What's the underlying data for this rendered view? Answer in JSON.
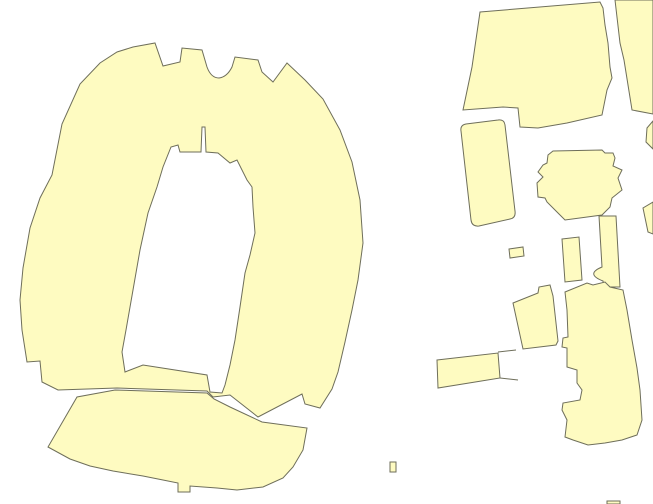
{
  "map": {
    "width": 653,
    "height": 504,
    "background_color": "#ffffff",
    "fill_color": "#FEFBC1",
    "outline_color": "#6E6E5A",
    "layer": "building-footprints",
    "shapes": [
      {
        "name": "feature-stadium-horseshoe",
        "kind": "polygon-with-hole",
        "d": "M27,362 L22,330 L20,300 L23,268 L30,228 L40,198 L52,175 L62,124 L80,84 L100,63 L117,52 L133,47 L155,43 L163,66 L180,62 L182,48 L202,50 L207,67 Q211,78 219,78 Q227,77 232,67 L235,57 L258,60 L262,72 L273,82 L287,63 L305,80 L323,99 L340,130 L352,162 L360,200 L363,243 L358,280 L352,310 L345,342 L338,372 L332,389 L320,408 L305,404 L302,394 L258,417 L230,395 L213,397 L207,391 L117,388 L58,390 L42,382 L40,361 Z M125,372 L122,352 L126,330 L133,290 L140,250 L148,213 L157,187 L163,167 L171,147 L178,145 L180,152 L192,152 L201,152 L202,127 L205,127 L206,152 L218,153 L230,163 L237,160 L247,180 L252,187 L253,207 L255,233 L250,255 L245,273 L240,307 L235,340 L230,365 L225,385 L222,393 L210,392 L207,375 L143,365 Z"
      },
      {
        "name": "feature-south-stands-fan",
        "kind": "polygon",
        "d": "M115,390 L207,393 L214,399 L230,407 L262,422 L307,428 L303,450 L293,467 L283,478 L263,487 L237,490 L217,488 L190,486 L190,492 L178,492 L178,483 L163,480 L143,476 L113,471 L90,466 L70,459 L48,447 L77,397 Z"
      },
      {
        "name": "feature-building-north-trapezoid",
        "kind": "polygon",
        "d": "M480,12 L600,2 L603,8 L605,25 L608,43 L610,67 L612,78 L607,90 L602,115 L567,123 L538,128 L520,127 L518,108 L503,107 L463,110 L472,67 Z"
      },
      {
        "name": "feature-building-top-right-edge",
        "kind": "polygon",
        "d": "M615,0 L620,43 L624,60 L632,110 L653,114 L653,0 Z"
      },
      {
        "name": "feature-building-right-edge-sliver-upper",
        "kind": "polygon",
        "d": "M653,121 L647,128 L646,142 L653,149 Z"
      },
      {
        "name": "feature-building-rounded-rect",
        "kind": "polygon",
        "d": "M466,124 L498,120 Q504,119 505,125 L515,211 Q516,218 510,219 L479,226 Q472,227 471,220 L461,131 Q460,125 466,124 Z"
      },
      {
        "name": "feature-building-cross",
        "kind": "polygon",
        "d": "M548,155 L553,151 L602,150 L605,153 L613,153 L615,158 L613,166 L622,170 L618,178 L622,190 L612,198 L610,207 L602,215 L565,220 L558,213 L547,202 L545,198 L538,197 L537,183 L543,177 L538,172 L543,165 L547,163 Z"
      },
      {
        "name": "feature-corridor-with-round-bump",
        "kind": "polygon",
        "d": "M599,216 L616,216 L620,287 L604,287 L603,281 Q585,274 602,267 Z"
      },
      {
        "name": "feature-building-right-edge-sliver-lower",
        "kind": "polygon",
        "d": "M653,202 L643,208 L648,232 L653,234 Z"
      },
      {
        "name": "feature-building-small-vertical-rect",
        "kind": "polygon",
        "d": "M562,239 L579,237 L582,280 L565,282 Z"
      },
      {
        "name": "feature-building-tiny-square",
        "kind": "polygon",
        "d": "M509,249 L523,247 L524,256 L510,258 Z"
      },
      {
        "name": "feature-building-notched-rect",
        "kind": "polygon",
        "d": "M513,303 L538,293 L539,287 L550,285 L553,296 L558,341 L556,345 L523,349 Z"
      },
      {
        "name": "feature-building-horizontal-bar",
        "kind": "polygon",
        "d": "M437,360 L498,353 L500,378 L438,388 Z"
      },
      {
        "name": "feature-horizontal-bar-spike-upper",
        "kind": "line",
        "d": "M498,352 L516,350"
      },
      {
        "name": "feature-horizontal-bar-spike-lower",
        "kind": "line",
        "d": "M500,378 L518,380"
      },
      {
        "name": "feature-building-south-complex",
        "kind": "polygon",
        "d": "M565,292 L587,283 L593,285 L605,282 L610,287 L623,290 L627,310 L632,340 L637,368 L640,390 L642,420 L637,435 L622,440 L605,443 L588,445 L573,440 L565,437 L567,420 L562,410 L563,403 L580,400 L582,390 L577,383 L577,370 L567,367 L567,348 L562,347 L563,338 L568,337 L567,310 Z"
      },
      {
        "name": "feature-tiny-speck",
        "kind": "polygon",
        "d": "M390,462 L396,462 L396,472 L390,472 Z"
      },
      {
        "name": "feature-building-bottom-edge",
        "kind": "polygon",
        "d": "M607,501 L620,501 L620,504 L607,504 Z"
      }
    ]
  }
}
